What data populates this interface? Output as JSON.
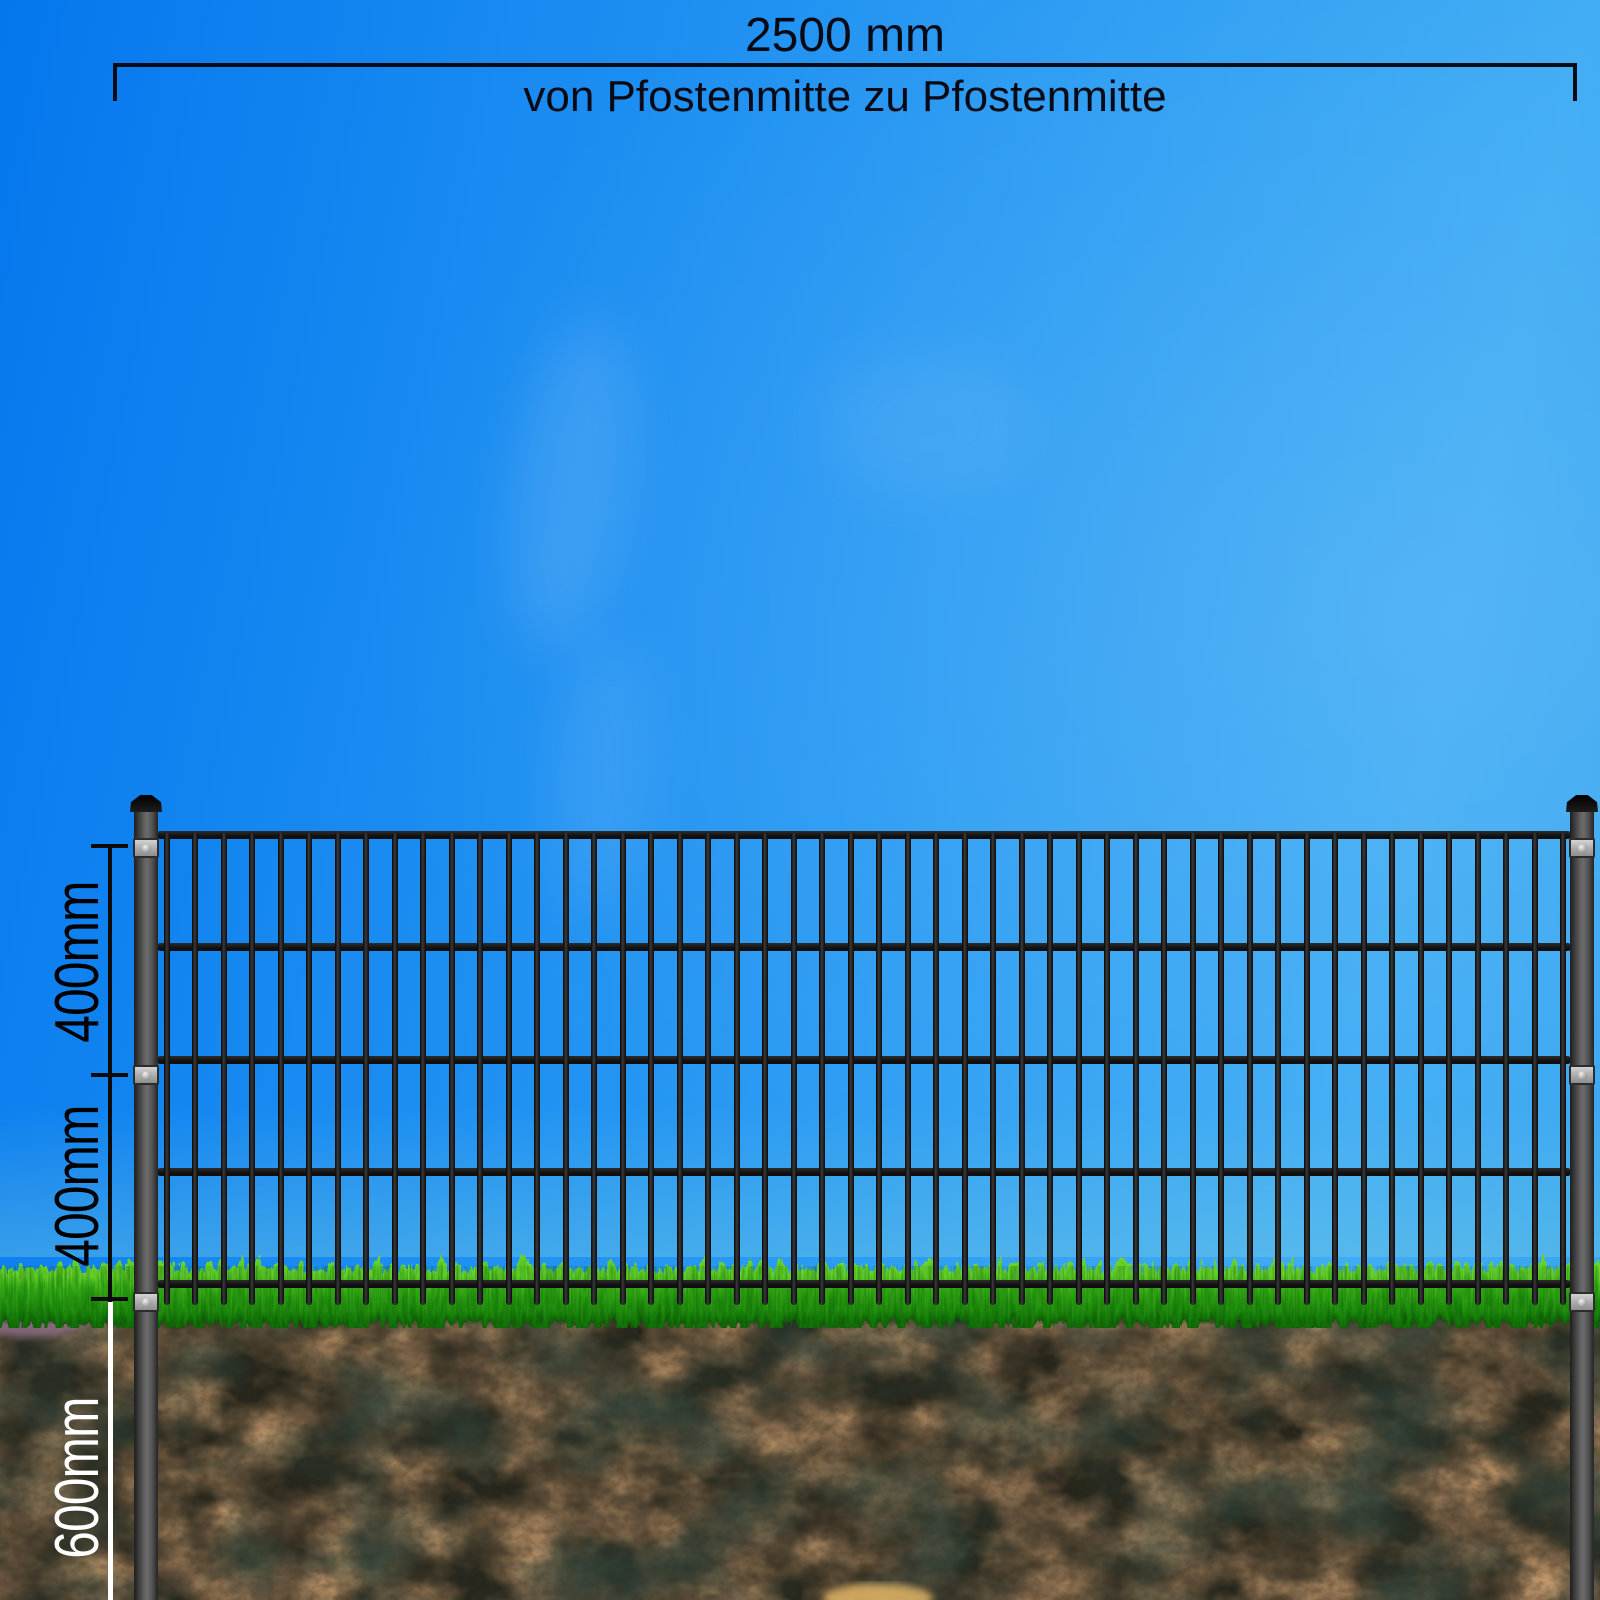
{
  "dimensions": {
    "span": {
      "value": "2500 mm",
      "note": "von Pfostenmitte zu Pfostenmitte"
    },
    "side": [
      {
        "id": "upper-panel-height",
        "label": "400mm",
        "color": "#000000"
      },
      {
        "id": "lower-panel-height",
        "label": "400mm",
        "color": "#000000"
      },
      {
        "id": "post-embed-depth",
        "label": "600mm",
        "color": "#ffffff"
      }
    ]
  },
  "fence": {
    "vertical_bar_count": 50,
    "horizontal_rail_count": 5,
    "post_count": 2,
    "brackets_per_post": 3
  },
  "icons": {
    "post_cap": "pyramid-post-cap-icon",
    "bracket_screw": "screw-icon"
  },
  "colors": {
    "sky_top_left": "#0577ee",
    "sky_right": "#3dabf4",
    "metal_dark": "#161616",
    "post_gray": "#5f5f5f",
    "bracket_gray": "#b5b5b5",
    "grass_bright": "#4ec321",
    "grass_dark": "#116307",
    "soil_base": "#6b5740",
    "soil_tan": "#c59a6e",
    "soil_dark": "#2e2c24",
    "dimension_black": "#0b0b12",
    "dimension_white": "#ffffff"
  }
}
